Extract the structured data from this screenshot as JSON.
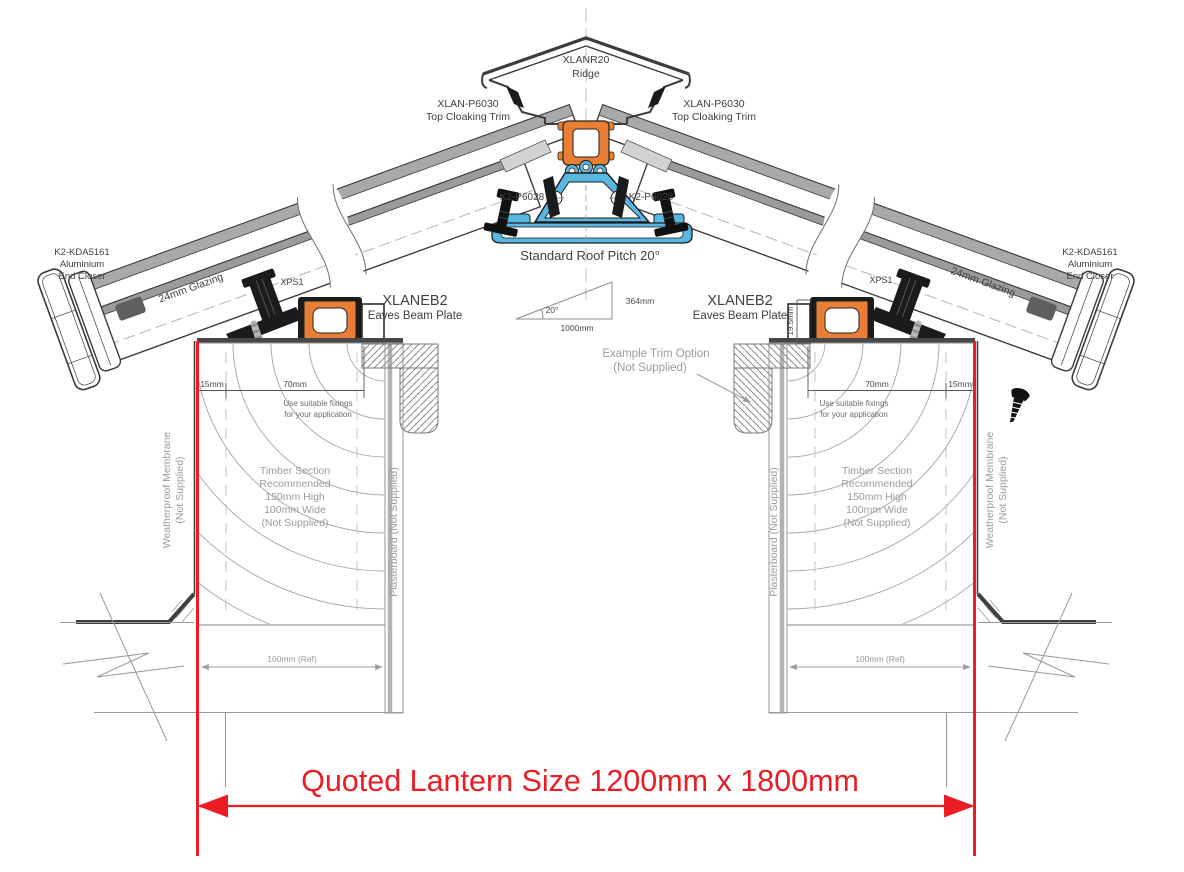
{
  "drawing": {
    "type": "roof-lantern-cross-section",
    "colors": {
      "accent_red": "#ec1c24",
      "profile_orange": "#e87f35",
      "profile_blue": "#58b8e2",
      "outline_gray": "#3c3c3c",
      "hatch_gray": "#a9a9a9"
    },
    "ridge": {
      "part": "XLANR20",
      "name": "Ridge"
    },
    "cloaking_trim": {
      "part": "XLAN-P6030",
      "name": "Top Cloaking Trim"
    },
    "ridge_bolt": {
      "part": "K2-P6028"
    },
    "pitch": {
      "title": "Standard Roof Pitch 20°",
      "angle": "20°",
      "run": "1000mm",
      "rise": "364mm"
    },
    "end_closer": {
      "part": "K2-KDA5161",
      "line2": "Aluminium",
      "line3": "End Closer"
    },
    "glazing": {
      "label": "24mm Glazing"
    },
    "xps": {
      "label": "XPS1"
    },
    "eaves_beam": {
      "part": "XLANEB2",
      "name": "Eaves Beam Plate"
    },
    "trim_option": {
      "line1": "Example  Trim Option",
      "line2": "(Not Supplied)"
    },
    "dims": {
      "d15": "15mm",
      "d70": "70mm",
      "d19_5": "19.5mm",
      "ref100": "100mm (Ref)"
    },
    "fixings_note": {
      "line1": "Use suitable fixings",
      "line2": "for your application"
    },
    "timber_note": {
      "line1": "Timber Section",
      "line2": "Recommended",
      "line3": "150mm High",
      "line4": "100mm Wide",
      "line5": "(Not Supplied)"
    },
    "membrane": {
      "line1": "Weatherproof Membrane",
      "line2": "(Not Supplied)"
    },
    "plasterboard": {
      "label": "Plasterboard (Not Supplied)"
    },
    "quoted": {
      "label": "Quoted Lantern Size 1200mm x 1800mm"
    }
  }
}
